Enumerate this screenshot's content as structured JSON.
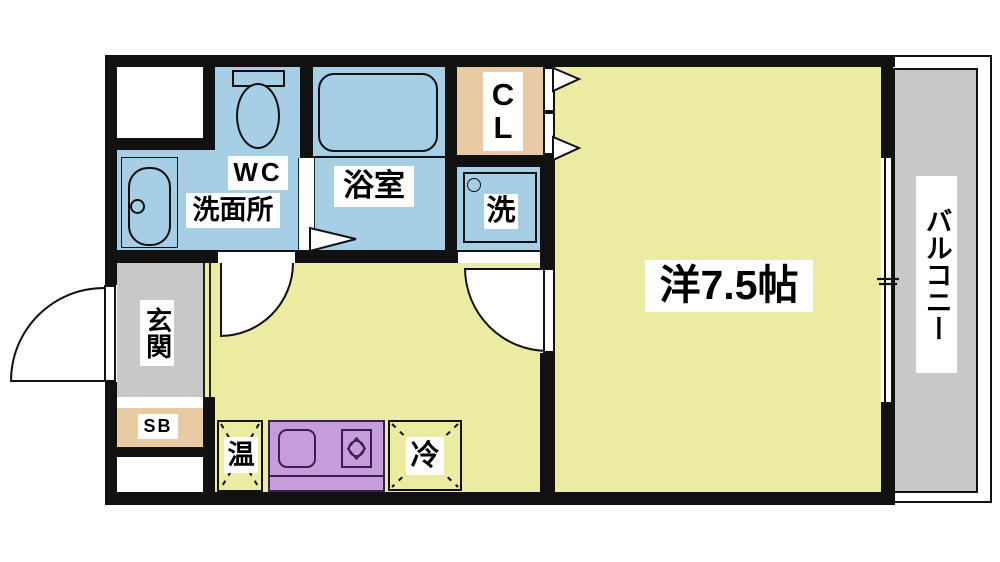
{
  "rooms": {
    "wc": {
      "label": "WC"
    },
    "washroom": {
      "label": "洗面所"
    },
    "bathroom": {
      "label": "浴室"
    },
    "laundry_space": {
      "label": "洗"
    },
    "closet": {
      "label_chars": [
        "C",
        "L"
      ]
    },
    "entrance": {
      "label": "玄関"
    },
    "shoe_box": {
      "label": "SB"
    },
    "water_heater_space": {
      "label": "温"
    },
    "refrigerator_space": {
      "label": "冷"
    },
    "western_room": {
      "label": "洋7.5帖"
    },
    "balcony": {
      "label": "バルコニー"
    }
  },
  "colors": {
    "wall": "#111111",
    "wet_room_blue": "#A6CEE4",
    "living_yellow": "#EBEBA1",
    "closet_tan": "#E8CBA2",
    "entrance_gray": "#C8C8C8",
    "balcony_gray": "#C8C8C8",
    "kitchen_counter_purple": "#C69CDA",
    "kitchen_counter_border": "#3A2052",
    "label_background": "#FFFFFF"
  }
}
